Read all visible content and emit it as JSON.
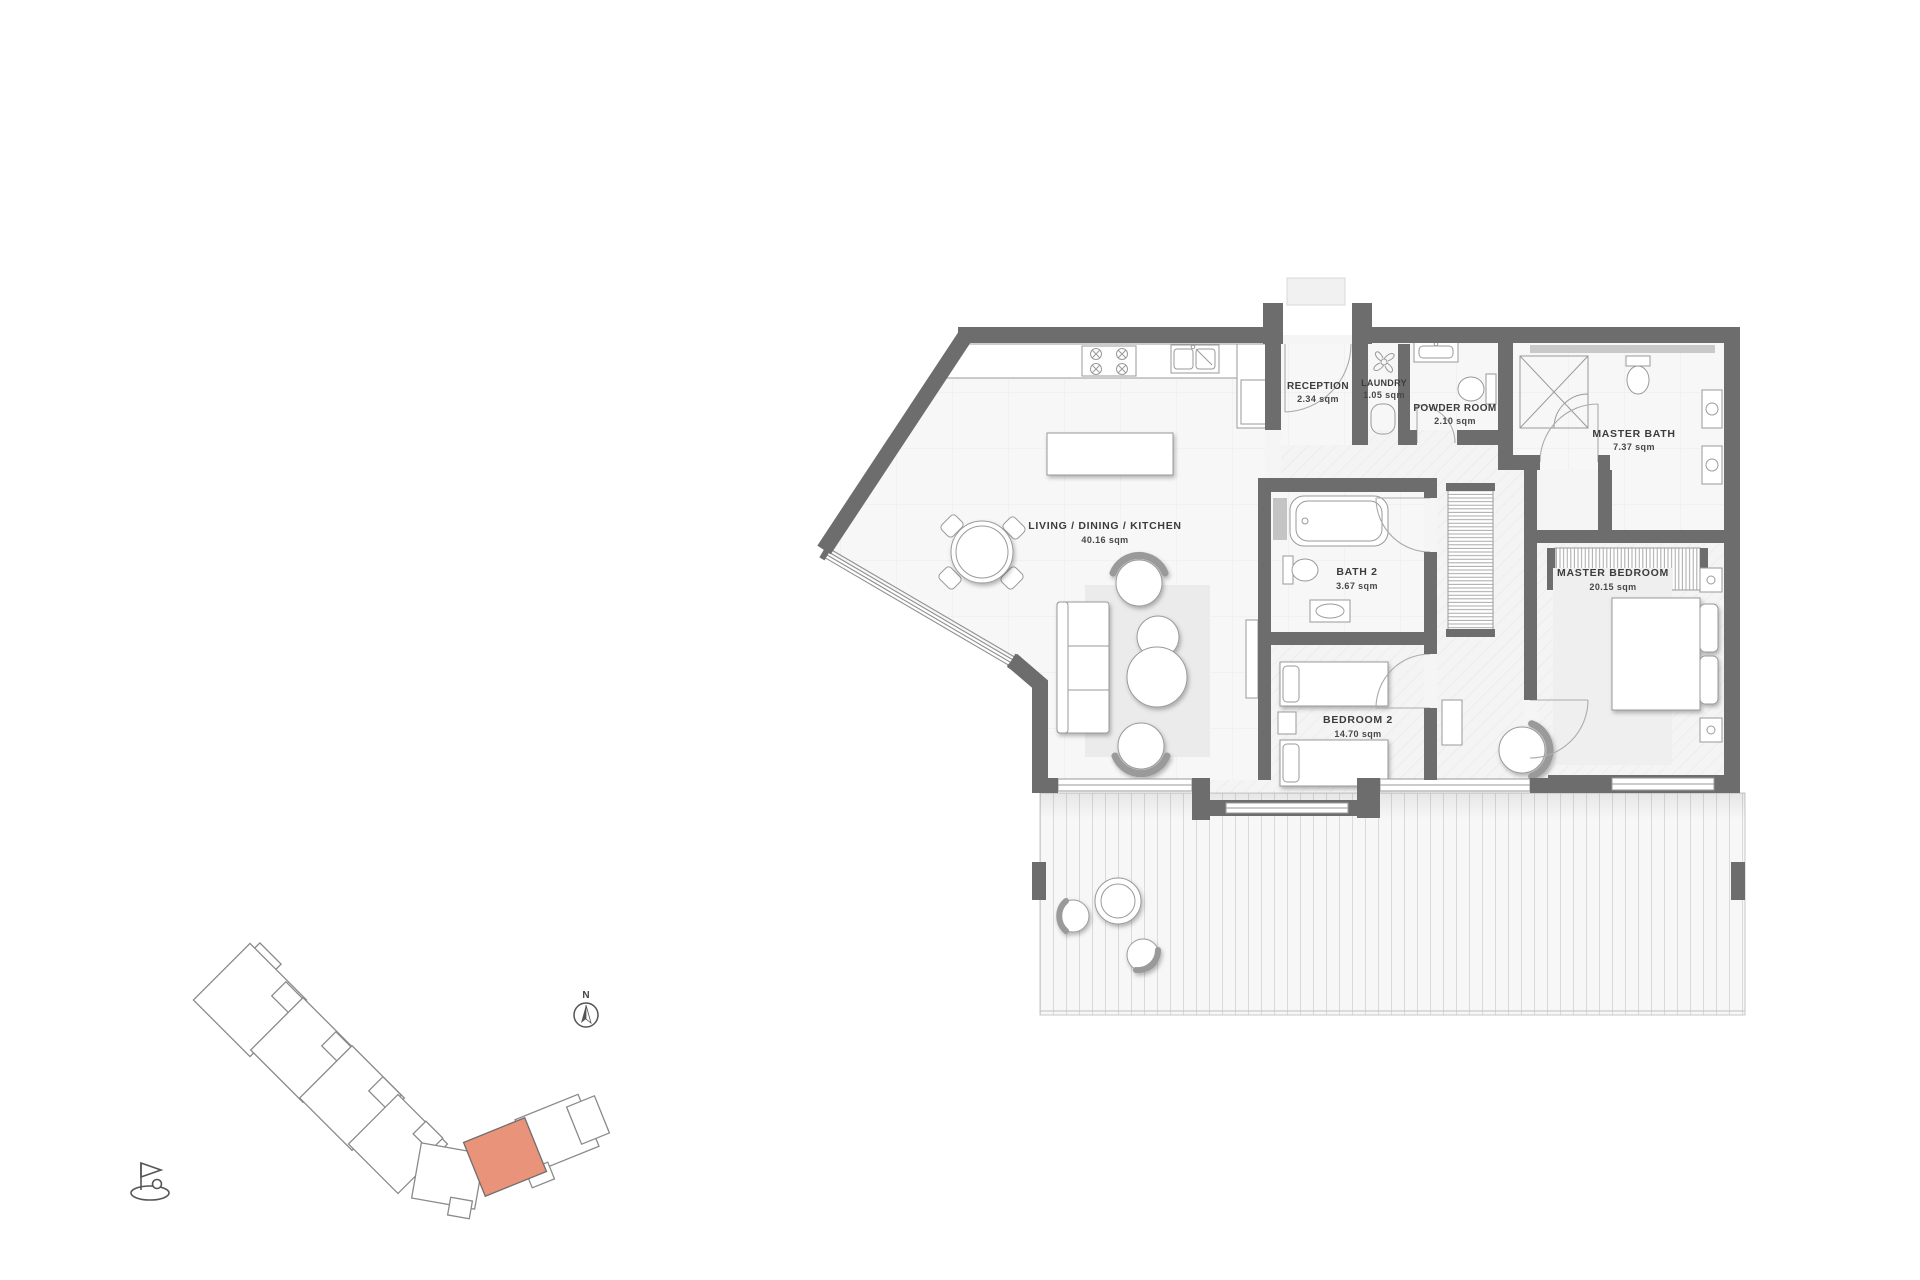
{
  "plan": {
    "rooms": [
      {
        "id": "living-dining-kitchen",
        "name": "LIVING / DINING / KITCHEN",
        "area": "40.16 sqm"
      },
      {
        "id": "reception",
        "name": "RECEPTION",
        "area": "2.34 sqm"
      },
      {
        "id": "laundry",
        "name": "LAUNDRY",
        "area": "1.05 sqm"
      },
      {
        "id": "powder-room",
        "name": "POWDER ROOM",
        "area": "2.10 sqm"
      },
      {
        "id": "master-bath",
        "name": "MASTER BATH",
        "area": "7.37 sqm"
      },
      {
        "id": "master-bedroom",
        "name": "MASTER BEDROOM",
        "area": "20.15 sqm"
      },
      {
        "id": "bath-2",
        "name": "BATH 2",
        "area": "3.67 sqm"
      },
      {
        "id": "bedroom-2",
        "name": "BEDROOM 2",
        "area": "14.70 sqm"
      }
    ],
    "compass": {
      "label": "N"
    },
    "colors": {
      "wall": "#6d6d6d",
      "floor": "#f6f6f6",
      "rug": "#ebebeb",
      "highlighted_unit": "#e8937a",
      "label": "#3c3c3c"
    },
    "icons": [
      "north-arrow-icon",
      "golf-flag-icon",
      "extractor-fan-icon"
    ]
  },
  "site_plan": {
    "highlighted_unit_color": "#e8937a"
  }
}
